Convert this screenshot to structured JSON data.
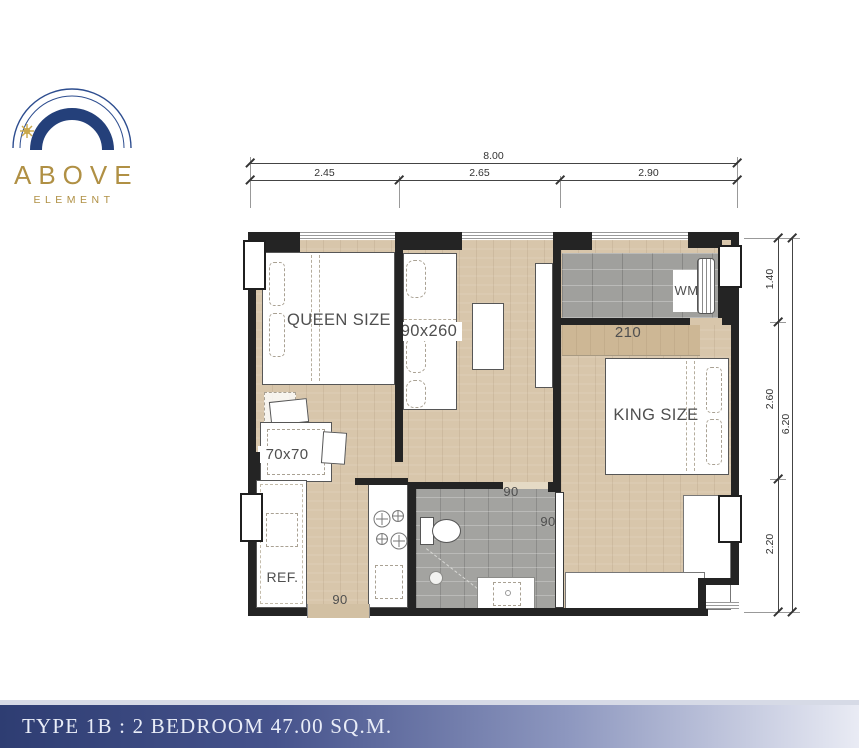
{
  "logo": {
    "brand": "ABOVE",
    "subtitle": "ELEMENT"
  },
  "dims": {
    "top_total": "8.00",
    "top_segments": [
      "2.45",
      "2.65",
      "2.90"
    ],
    "right_total": "6.20",
    "right_segments": [
      "1.40",
      "2.60",
      "2.20"
    ]
  },
  "plan": {
    "queen_label": "QUEEN SIZE",
    "king_label": "KING SIZE",
    "dining_label": "90x260",
    "small_table_label": "70x70",
    "fridge_label": "REF.",
    "washer_label": "WM",
    "wardrobe_label": "210",
    "entry_door_label": "90",
    "bath_door_label": "90",
    "bed_door_label": "90"
  },
  "footer": {
    "title": "TYPE 1B : 2 BEDROOM 47.00 SQ.M."
  },
  "colors": {
    "navy": "#24407a",
    "gold": "#b09044",
    "wood": "#d8c6ab",
    "tile": "#a0a09d",
    "wall": "#242424",
    "footer_left": "#2e3d72",
    "footer_right": "#e9ebf4"
  }
}
